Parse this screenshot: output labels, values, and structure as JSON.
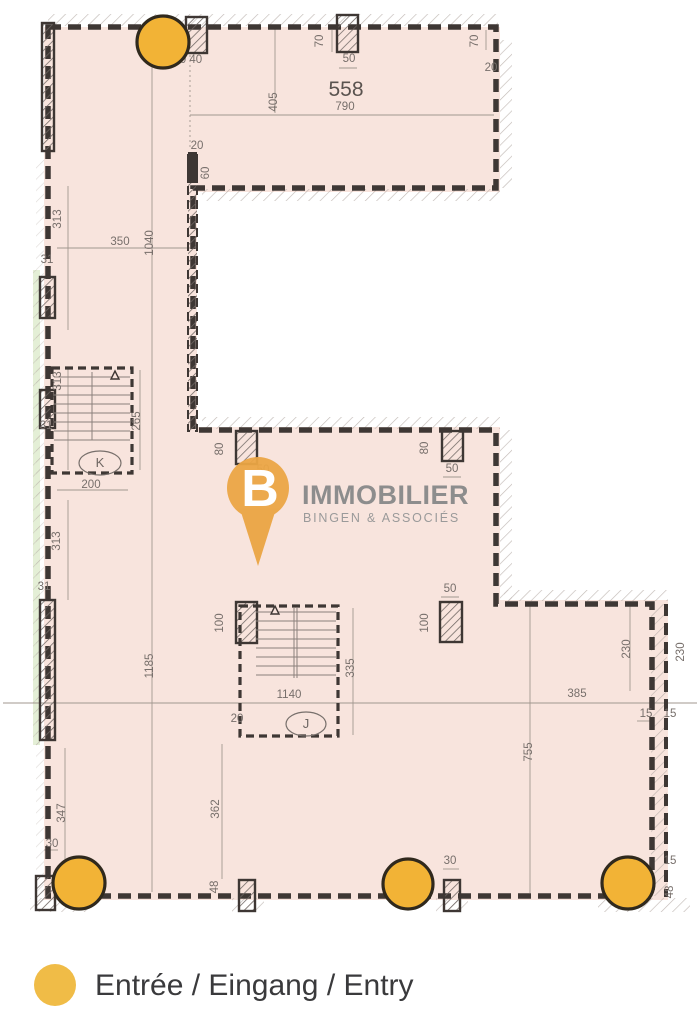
{
  "legend": {
    "entry_label": "Entrée / Eingang / Entry"
  },
  "logo": {
    "letter": "B",
    "name": "IMMOBILIER",
    "subtitle": "BINGEN & ASSOCIÉS"
  },
  "room_label": "558",
  "stairs": {
    "k": "K",
    "j": "J"
  },
  "dimensions": [
    "70",
    "50",
    "790",
    "405",
    "70",
    "20",
    "0 40",
    "20",
    "60",
    "313",
    "350",
    "1040",
    "31",
    "313",
    "265",
    "200",
    "31",
    "80",
    "80",
    "50",
    "313",
    "31",
    "1185",
    "100",
    "50",
    "100",
    "230",
    "230",
    "335",
    "1140",
    "20",
    "385",
    "15",
    "15",
    "755",
    "347",
    "30",
    "362",
    "48",
    "30",
    "15",
    "48",
    "50"
  ],
  "colors": {
    "floor": "#f8e4dd",
    "wall": "#3e3734",
    "entrance": "#f2b336",
    "entrance_stroke": "#30291d",
    "legend_dot": "#f0bc47",
    "logo_pin": "#eba544",
    "logo_text": "#8d8d8d",
    "dim_text": "#776f6b",
    "green_strip": "#e4efd6"
  }
}
